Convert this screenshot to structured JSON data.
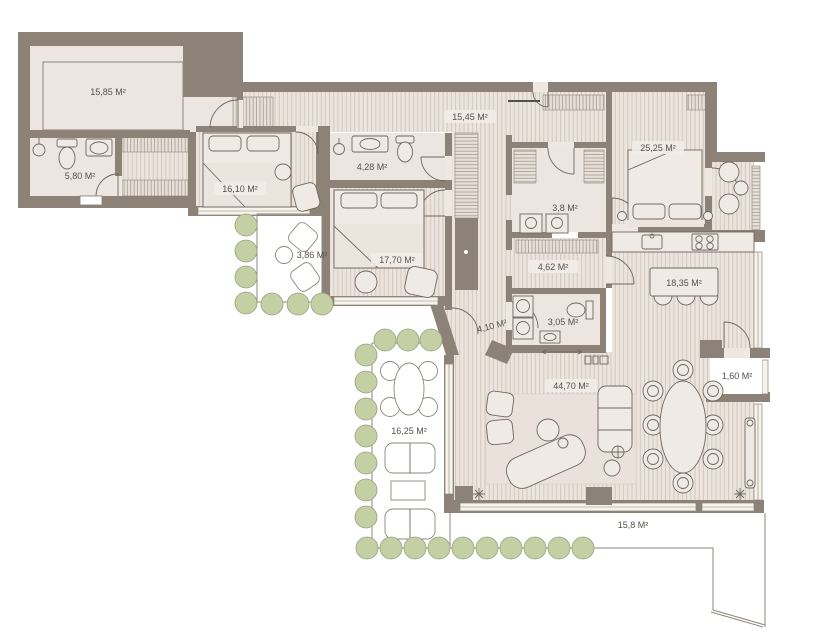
{
  "title": "Apartment floor plan",
  "colors": {
    "wall": "#8C8278",
    "floor": "#EDE6E0",
    "floor_hatch_bg": "#ECE4DD",
    "floor_hatch_line": "#CFC5BA",
    "closet_hatch_line": "#9C9287",
    "furniture_fill": "#F0EAE4",
    "furniture_line": "#6F685F",
    "thin_outline": "#8E867C",
    "plant_fill": "#C4CFA3",
    "plant_stroke": "#96A182",
    "label_text": "#55504A"
  },
  "rooms": [
    {
      "id": "room-top-left",
      "area": "15,85 М²"
    },
    {
      "id": "bathroom-1",
      "area": "5,80 М²"
    },
    {
      "id": "bedroom-1",
      "area": "16,10 М²"
    },
    {
      "id": "bathroom-2",
      "area": "4,28 М²"
    },
    {
      "id": "bedroom-2",
      "area": "17,70 М²"
    },
    {
      "id": "balcony-1",
      "area": "3,86 М²"
    },
    {
      "id": "corridor",
      "area": "15,45 М²"
    },
    {
      "id": "bathroom-3",
      "area": "3,8 М²"
    },
    {
      "id": "bedroom-3",
      "area": "25,25 М²"
    },
    {
      "id": "wardrobe",
      "area": "4,62 М²"
    },
    {
      "id": "kitchen",
      "area": "18,35 М²"
    },
    {
      "id": "hallway",
      "area": "4,10 М²"
    },
    {
      "id": "wc",
      "area": "3,05 М²"
    },
    {
      "id": "living-room",
      "area": "44,70 М²"
    },
    {
      "id": "balcony-2",
      "area": "1,60 М²"
    },
    {
      "id": "terrace-1",
      "area": "16,25 М²"
    },
    {
      "id": "terrace-2",
      "area": "15,8 М²"
    }
  ]
}
